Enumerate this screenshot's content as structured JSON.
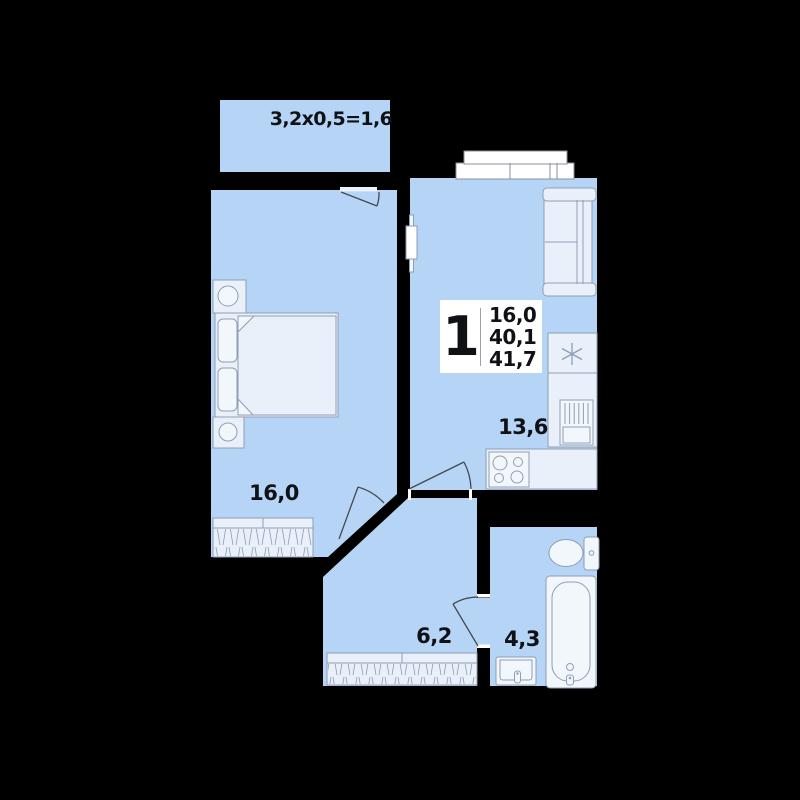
{
  "balcony": {
    "dimension": "3,2x0,5=1,6"
  },
  "unit_badge": {
    "rooms": "1",
    "areas": [
      "16,0",
      "40,1",
      "41,7"
    ]
  },
  "rooms": [
    {
      "id": "bedroom",
      "area": "16,0"
    },
    {
      "id": "kitchen-living",
      "area": "13,6"
    },
    {
      "id": "hallway",
      "area": "6,2"
    },
    {
      "id": "bathroom",
      "area": "4,3"
    }
  ],
  "icons": {
    "fridge": "snowflake-icon"
  },
  "colors": {
    "wall": "#000000",
    "room_fill": "#b5d4f6",
    "furniture_fill": "#e9f0fa",
    "fixture_fill": "#f2f7fc",
    "outline": "#8e9eb5",
    "door_line": "#45494f",
    "text": "#101114",
    "badge_bg": "#ffffff",
    "window_fill": "#ffffff",
    "window_outline": "#8b8f98",
    "threshold": "#e9f1fb"
  }
}
